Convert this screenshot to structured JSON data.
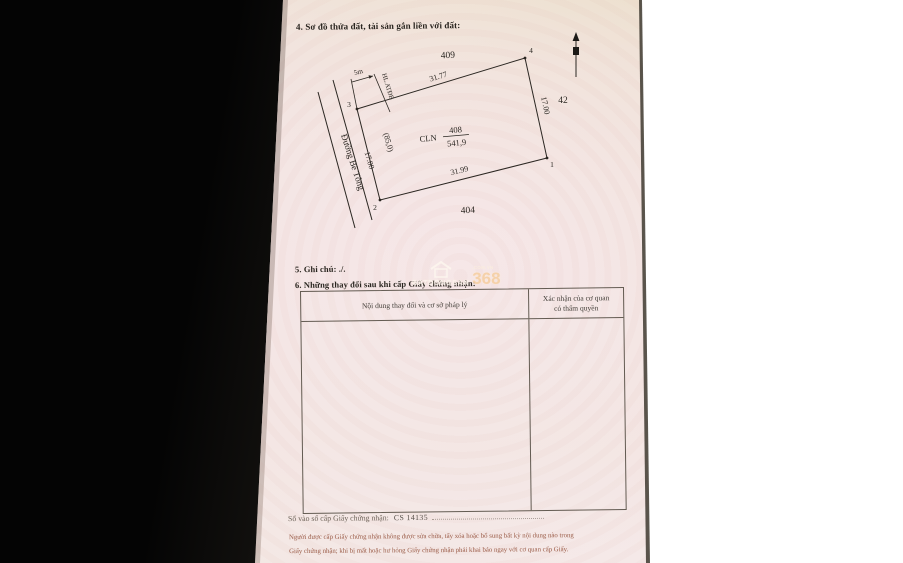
{
  "page": {
    "section4_title": "4. Sơ đồ thửa đất, tài sản gắn liền với đất:",
    "section5_title": "5. Ghi chú: ./.",
    "section6_title": "6. Những thay đổi sau khi cấp Giấy chứng nhận:"
  },
  "diagram": {
    "adjacent_plots": {
      "top": "409",
      "right": "42",
      "bottom": "404"
    },
    "parcel": {
      "prefix": "CLN",
      "number": "408",
      "area": "541,9"
    },
    "corners": {
      "c1": "1",
      "c2": "2",
      "c3": "3",
      "c4": "4"
    },
    "edges": {
      "top": "31.77",
      "bottom": "31.99",
      "right": "17.00",
      "left": "17.00",
      "left_paren": "(85,0)"
    },
    "road_label": "Đường Bê Tông",
    "hl_label": "HL.ATĐB",
    "dim_5m": "5m"
  },
  "table": {
    "col1_header": "Nội dung thay đổi và cơ sở pháp lý",
    "col2_header_line1": "Xác nhận của cơ quan",
    "col2_header_line2": "có thẩm quyền"
  },
  "footer": {
    "registry_label": "Số vào sổ cấp Giấy chứng nhận:",
    "registry_value": "CS 14135",
    "legal_line1": "Người được cấp Giấy chứng nhận không được sửa chữa, tẩy xóa hoặc bổ sung bất kỳ nội dung nào trong",
    "legal_line2": "Giấy chứng nhận; khi bị mất hoặc hư hỏng Giấy chứng nhận phải khai báo ngay với cơ quan cấp Giấy."
  },
  "watermark": {
    "brand": "BATDONGSAN",
    "number": "368",
    "domain": ".COM.VN"
  },
  "colors": {
    "page_pink": "#f5e8e8",
    "page_beige": "#e8dcc2",
    "ink": "#2b2722",
    "legal_red": "#9a5b47",
    "black_backdrop": "#0b0b0b",
    "watermark_orange": "#f6cfa2"
  }
}
